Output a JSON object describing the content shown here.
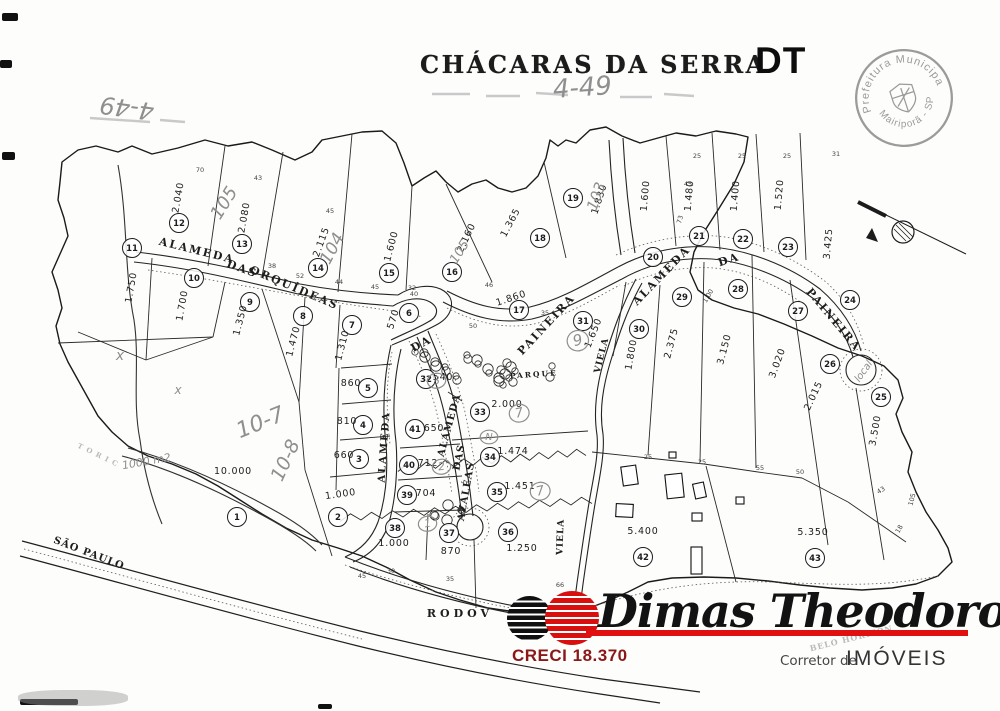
{
  "header": {
    "title": "CHÁCARAS DA SERRA",
    "dt_mark": "DT",
    "handwritten_ref": "4-49"
  },
  "stamp": {
    "arc_top": "Prefeitura Municipal",
    "arc_bottom": "Mairiporã - SP"
  },
  "footer": {
    "brand": "Dimas Theodoro",
    "creci": "CRECI 18.370",
    "role_prefix": "Corretor de",
    "role": "IMÓVEIS"
  },
  "colors": {
    "accent_red": "#e11010",
    "creci_red": "#8b1818",
    "pencil_gray": "#8f8f8f",
    "ink": "#1d1d1d",
    "stamp_gray": "#8a8a8a"
  },
  "map": {
    "lots": [
      [
        "1",
        237,
        517,
        "10.000",
        233,
        474,
        0
      ],
      [
        "2",
        338,
        517,
        "1.000",
        341,
        497,
        -8
      ],
      [
        "3",
        359,
        459,
        "660",
        344,
        458,
        0
      ],
      [
        "4",
        363,
        425,
        "810",
        347,
        424,
        0
      ],
      [
        "5",
        368,
        388,
        "860",
        351,
        386,
        0
      ],
      [
        "6",
        409,
        313,
        "570",
        396,
        320,
        -72
      ],
      [
        "7",
        352,
        325,
        "1.310",
        345,
        346,
        -75
      ],
      [
        "8",
        303,
        316,
        "1.470",
        296,
        342,
        -75
      ],
      [
        "9",
        250,
        302,
        "1.350",
        243,
        321,
        -75
      ],
      [
        "10",
        194,
        278,
        "1.700",
        185,
        306,
        -80
      ],
      [
        "11",
        132,
        248,
        "1.750",
        134,
        288,
        -80
      ],
      [
        "12",
        179,
        223,
        "2.040",
        181,
        198,
        -80
      ],
      [
        "13",
        242,
        244,
        "2.080",
        247,
        218,
        -80
      ],
      [
        "14",
        318,
        268,
        "2.115",
        324,
        243,
        -70
      ],
      [
        "15",
        389,
        273,
        "1.600",
        394,
        247,
        -75
      ],
      [
        "16",
        452,
        272,
        "2.160",
        469,
        239,
        -65
      ],
      [
        "17",
        519,
        310,
        "1.860",
        512,
        301,
        -18
      ],
      [
        "18",
        540,
        238,
        "1.365",
        513,
        224,
        -62
      ],
      [
        "19",
        573,
        198,
        "1.830",
        602,
        200,
        -72
      ],
      [
        "20",
        653,
        257,
        "1.600",
        648,
        196,
        -85
      ],
      [
        "21",
        699,
        236,
        "1.480",
        692,
        196,
        -85
      ],
      [
        "22",
        743,
        239,
        "1.400",
        738,
        196,
        -85
      ],
      [
        "23",
        788,
        247,
        "1.520",
        782,
        195,
        -85
      ],
      [
        "24",
        850,
        300,
        "3.425",
        831,
        244,
        -85
      ],
      [
        "25",
        881,
        397,
        "3.500",
        878,
        431,
        -80
      ],
      [
        "26",
        830,
        364,
        "2.015",
        816,
        397,
        -65
      ],
      [
        "27",
        798,
        311,
        "3.020",
        780,
        364,
        -70
      ],
      [
        "28",
        738,
        289,
        "3.150",
        727,
        350,
        -75
      ],
      [
        "29",
        682,
        297,
        "2.375",
        674,
        344,
        -75
      ],
      [
        "30",
        639,
        329,
        "1.800",
        634,
        355,
        -80
      ],
      [
        "31",
        583,
        321,
        "1.650",
        596,
        334,
        -68
      ],
      [
        "32",
        426,
        379,
        "540",
        443,
        380,
        0
      ],
      [
        "33",
        480,
        412,
        "2.000",
        507,
        407,
        0
      ],
      [
        "34",
        490,
        457,
        "1.474",
        513,
        454,
        0
      ],
      [
        "35",
        497,
        492,
        "1.451",
        520,
        489,
        0
      ],
      [
        "36",
        508,
        532,
        "1.250",
        522,
        551,
        0
      ],
      [
        "37",
        449,
        533,
        "870",
        451,
        554,
        0
      ],
      [
        "38",
        395,
        528,
        "1.000",
        394,
        546,
        0
      ],
      [
        "39",
        407,
        495,
        "704",
        426,
        496,
        0
      ],
      [
        "40",
        409,
        465,
        "712",
        428,
        466,
        0
      ],
      [
        "41",
        415,
        429,
        "650",
        434,
        431,
        0
      ],
      [
        "42",
        643,
        557,
        "5.400",
        643,
        534,
        0
      ],
      [
        "43",
        815,
        558,
        "5.350",
        813,
        535,
        0
      ]
    ],
    "streets": [
      [
        "ALAMEDA",
        196,
        254,
        14,
        11,
        2,
        0
      ],
      [
        "DAS",
        241,
        272,
        20,
        11,
        2,
        0
      ],
      [
        "ORQUÍDEAS",
        293,
        291,
        23,
        11,
        2,
        0
      ],
      [
        "ALAMEDA",
        664,
        278,
        -46,
        11,
        2,
        0
      ],
      [
        "DA",
        730,
        263,
        -18,
        11,
        2,
        0
      ],
      [
        "PAINEIRA",
        831,
        322,
        50,
        11,
        2,
        0
      ],
      [
        "PAINEIRA",
        549,
        327,
        -47,
        11,
        2,
        0
      ],
      [
        "DA",
        423,
        347,
        -28,
        11,
        2,
        0
      ],
      [
        "ALAMEDA",
        387,
        447,
        -86,
        10,
        2,
        0
      ],
      [
        "ALAMEDA",
        452,
        426,
        -75,
        10,
        1,
        0
      ],
      [
        "DAS",
        462,
        458,
        -78,
        10,
        1,
        0
      ],
      [
        "AZALÉAS",
        469,
        492,
        -80,
        10,
        1,
        0
      ],
      [
        "VIELA",
        604,
        356,
        -76,
        9,
        1,
        0
      ],
      [
        "VIELA",
        563,
        537,
        -88,
        9,
        1,
        0
      ],
      [
        "PARQUE",
        534,
        377,
        -4,
        7.5,
        2,
        0
      ],
      [
        "SÃO PAULO",
        88,
        556,
        21,
        10,
        1,
        0
      ],
      [
        "RODOV",
        460,
        617,
        0,
        11,
        4,
        0
      ],
      [
        "BELO HORIZON",
        852,
        641,
        -14,
        8,
        1,
        1
      ],
      [
        "T O R I C",
        97,
        457,
        26,
        7,
        1,
        1
      ]
    ],
    "handwritten": [
      [
        "4-49",
        128,
        100,
        188,
        24,
        0
      ],
      [
        "4-49",
        583,
        96,
        -4,
        26,
        0
      ],
      [
        "105",
        229,
        206,
        -58,
        18,
        0
      ],
      [
        "104",
        337,
        251,
        -62,
        17,
        0
      ],
      [
        "103",
        601,
        198,
        -70,
        15,
        0
      ],
      [
        "105",
        463,
        254,
        -58,
        13,
        0
      ],
      [
        "10-7",
        263,
        429,
        -22,
        22,
        0
      ],
      [
        "10-8",
        291,
        463,
        -65,
        19,
        0
      ],
      [
        "1000 m2",
        147,
        465,
        -10,
        11,
        0
      ],
      [
        "9",
        579,
        345,
        -15,
        15,
        1
      ],
      [
        "7",
        520,
        417,
        -12,
        13,
        1
      ],
      [
        "7",
        541,
        495,
        -12,
        13,
        1
      ],
      [
        "2",
        442,
        470,
        -8,
        11,
        1
      ],
      [
        "3",
        437,
        384,
        -8,
        11,
        1
      ],
      [
        "1",
        428,
        527,
        -8,
        11,
        1
      ],
      [
        "N",
        489,
        440,
        0,
        10,
        1
      ],
      [
        "local",
        866,
        373,
        -55,
        10,
        0
      ],
      [
        "x",
        120,
        360,
        0,
        14,
        0
      ],
      [
        "x",
        178,
        394,
        0,
        12,
        0
      ]
    ],
    "edge_numbers": [
      [
        "70",
        200,
        172,
        0
      ],
      [
        "43",
        258,
        180,
        0
      ],
      [
        "45",
        330,
        213,
        0
      ],
      [
        "45",
        688,
        186,
        0
      ],
      [
        "25",
        697,
        158,
        0
      ],
      [
        "25",
        742,
        158,
        0
      ],
      [
        "25",
        787,
        158,
        0
      ],
      [
        "31",
        836,
        156,
        0
      ],
      [
        "73",
        682,
        220,
        -75
      ],
      [
        "46",
        489,
        287,
        0
      ],
      [
        "32",
        412,
        290,
        0
      ],
      [
        "38",
        272,
        268,
        0
      ],
      [
        "52",
        300,
        278,
        0
      ],
      [
        "44",
        339,
        284,
        0
      ],
      [
        "45",
        375,
        289,
        0
      ],
      [
        "40",
        414,
        296,
        0
      ],
      [
        "25",
        648,
        459,
        0
      ],
      [
        "25",
        702,
        464,
        0
      ],
      [
        "55",
        760,
        470,
        0
      ],
      [
        "50",
        800,
        474,
        0
      ],
      [
        "43",
        882,
        492,
        -30
      ],
      [
        "18",
        901,
        530,
        -60
      ],
      [
        "30",
        391,
        573,
        0
      ],
      [
        "45",
        362,
        578,
        0
      ],
      [
        "35",
        450,
        581,
        0
      ],
      [
        "66",
        560,
        587,
        0
      ],
      [
        "105",
        914,
        500,
        -75
      ],
      [
        "1.00",
        710,
        297,
        -60
      ],
      [
        "50",
        473,
        328,
        0
      ],
      [
        "35",
        545,
        315,
        0
      ]
    ],
    "buildings": [
      [
        622,
        466,
        15,
        19,
        -8
      ],
      [
        666,
        474,
        17,
        24,
        -6
      ],
      [
        694,
        483,
        11,
        15,
        -12
      ],
      [
        616,
        504,
        17,
        13,
        3
      ],
      [
        692,
        513,
        10,
        8,
        0
      ],
      [
        691,
        547,
        11,
        27,
        0
      ],
      [
        736,
        497,
        8,
        7,
        0
      ],
      [
        669,
        452,
        7,
        6,
        0
      ]
    ],
    "tree_clusters": [
      [
        415,
        352,
        85,
        30,
        16
      ],
      [
        498,
        360,
        55,
        26,
        11
      ],
      [
        428,
        505,
        40,
        16,
        6
      ]
    ]
  }
}
